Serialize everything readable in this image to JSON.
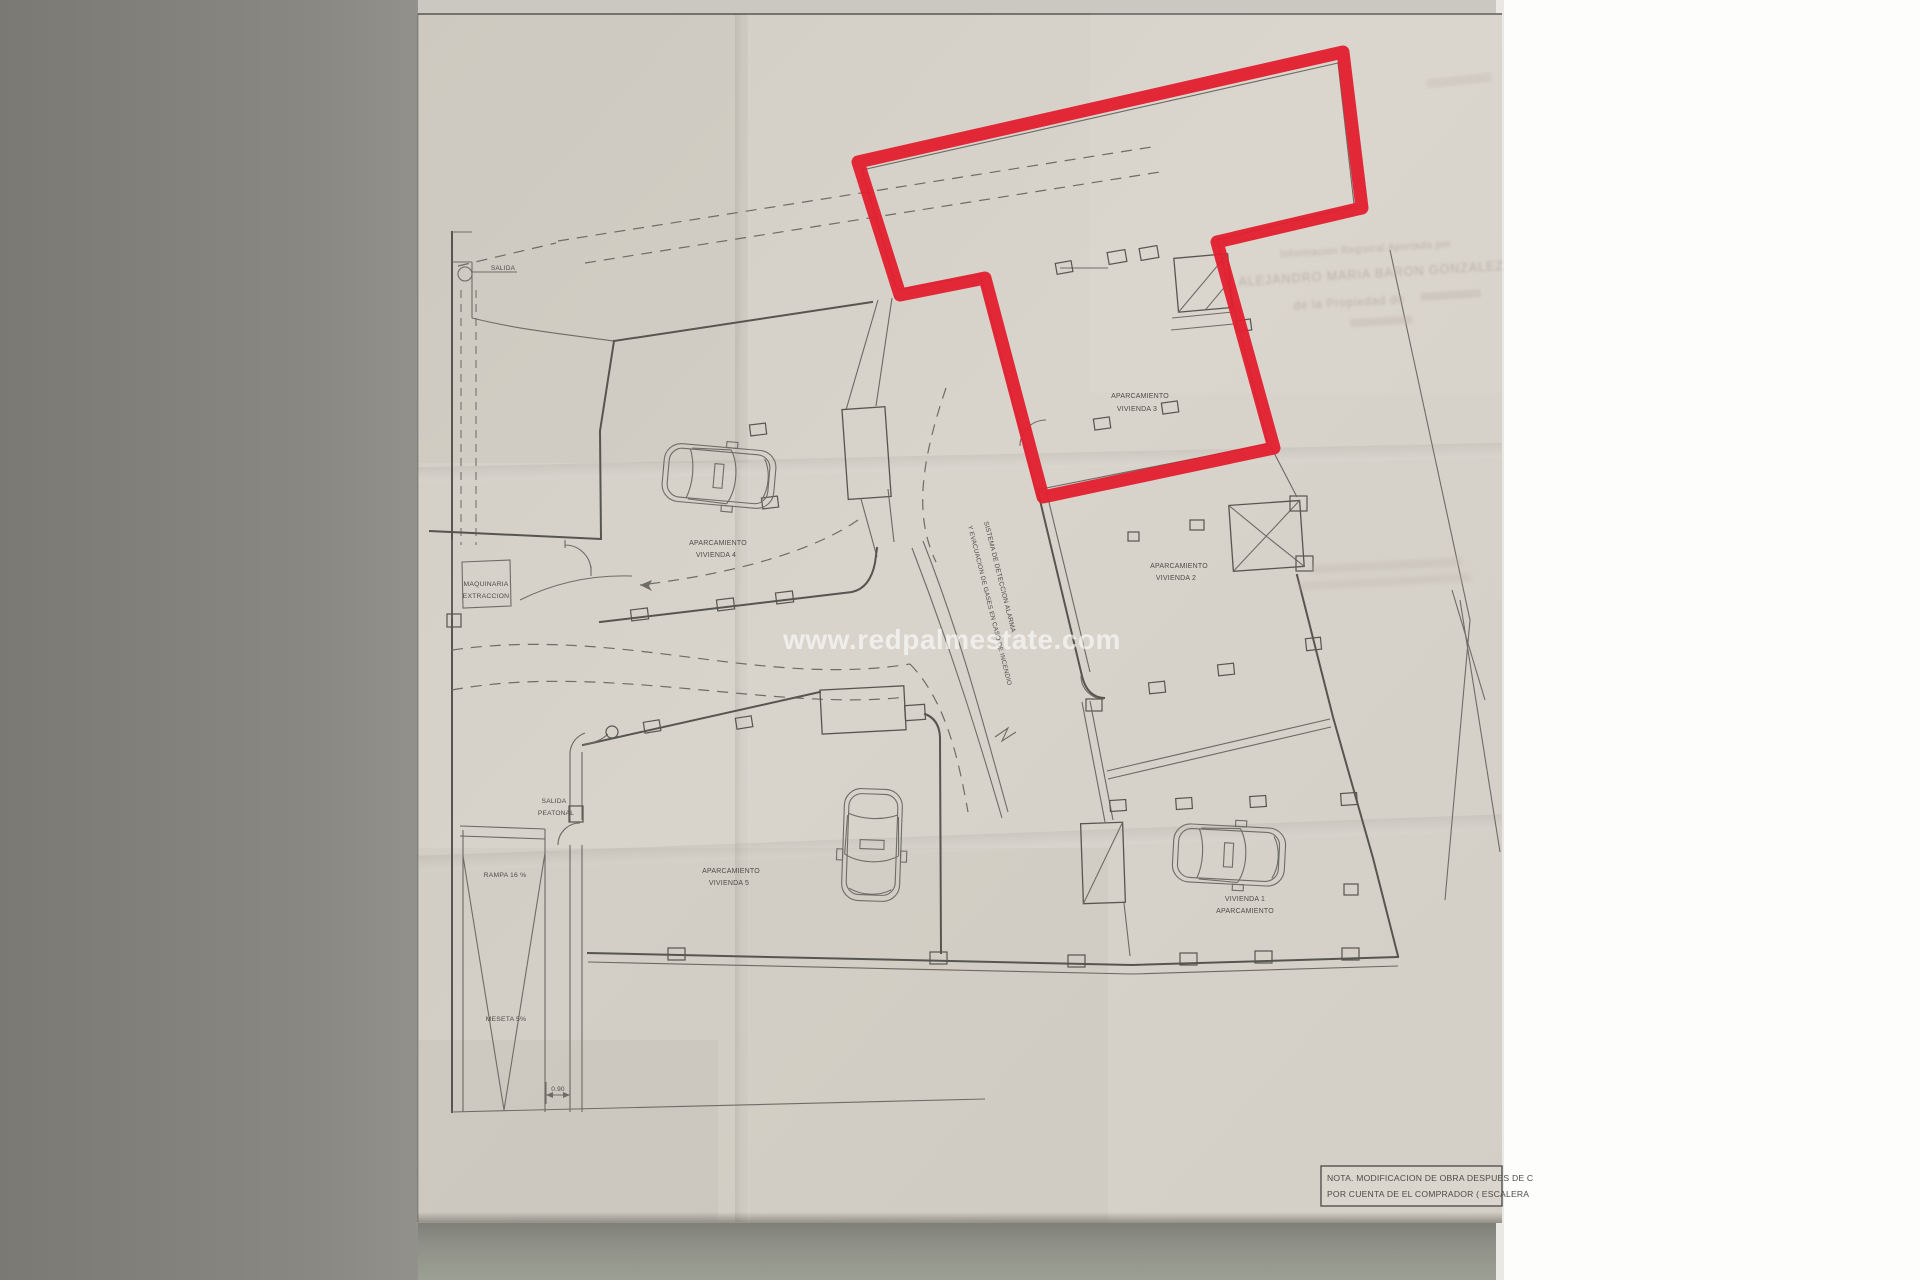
{
  "photo": {
    "description": "photograph of folded architectural floor plan sheet",
    "colors": {
      "paper": "#d7d3cb",
      "table_left": "#817f7a",
      "table_bottom": "#90928a",
      "white_margin": "#fdfdfc",
      "ink": "#4e4c48",
      "highlight_red": "#e31f2e",
      "watermark_white": "#ffffff",
      "ghost_text": "#b3a69c"
    }
  },
  "watermark": {
    "text": "www.redpalmestate.com"
  },
  "plan": {
    "labels": {
      "salida": {
        "l1": "SALIDA"
      },
      "viv4": {
        "l1": "APARCAMIENTO",
        "l2": "VIVIENDA 4"
      },
      "maquinaria": {
        "l1": "MAQUINARIA",
        "l2": "EXTRACCION"
      },
      "viv3": {
        "l1": "APARCAMIENTO",
        "l2": "VIVIENDA 3"
      },
      "viv2": {
        "l1": "APARCAMIENTO",
        "l2": "VIVIENDA 2"
      },
      "salida_peatonal": {
        "l1": "SALIDA",
        "l2": "PEATONAL"
      },
      "rampa": {
        "l1": "RAMPA 16 %"
      },
      "viv5": {
        "l1": "APARCAMIENTO",
        "l2": "VIVIENDA 5"
      },
      "viv1": {
        "l1": "VIVIENDA 1",
        "l2": "APARCAMIENTO"
      },
      "meseta": {
        "l1": "MESETA 5%"
      },
      "sistema": {
        "l1": "SISTEMA DE DETECCION ALARMA",
        "l2": "Y EVACUACION DE GASES EN CASO DE INCENDIO"
      }
    },
    "dimension": {
      "value": "0.90"
    },
    "note_box": {
      "l1": "NOTA. MODIFICACION DE OBRA DESPUES DE C",
      "l2": "POR CUENTA DE EL COMPRADOR ( ESCALERA"
    }
  },
  "ghost_text": {
    "l1": "Informacion Registral Aportada por",
    "l2": "ALEJANDRO MARIA BARON GONZALEZ",
    "l3": "de la Propiedad de"
  }
}
